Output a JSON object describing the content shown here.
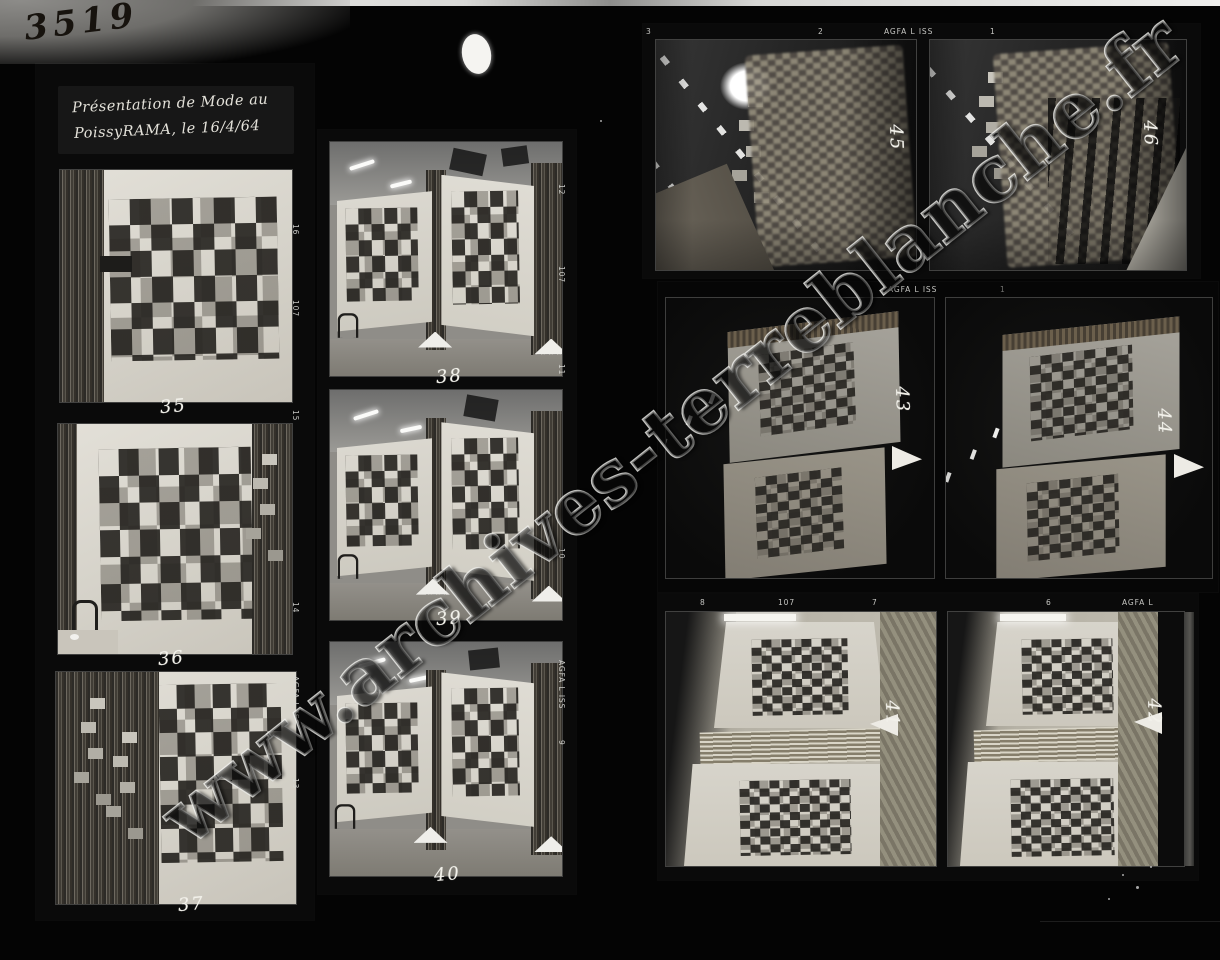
{
  "sheet": {
    "handwritten_number": "3519",
    "caption_line1": "Présentation de Mode au",
    "caption_line2": "PoissyRAMA, le 16/4/64",
    "watermark": "www.archives-terreblanche.fr"
  },
  "frame_numbers": {
    "f35": "35",
    "f36": "36",
    "f37": "37",
    "f38": "38",
    "f39": "39",
    "f40": "40",
    "f41": "41",
    "f42": "42",
    "f43": "43",
    "f44": "44",
    "f45": "45",
    "f46": "46"
  },
  "film_edge_markings": {
    "left_strip": [
      "16",
      "107",
      "15",
      "14",
      "AGFA L ISS",
      "13"
    ],
    "middle_strip": [
      "12",
      "107",
      "11",
      "10",
      "AGFA L ISS",
      "9"
    ],
    "top_right_strip": [
      "3",
      "2",
      "AGFA L ISS",
      "1"
    ],
    "middle_right_strip": [
      "AGFA L ISS",
      "1"
    ],
    "bottom_right_strip": [
      "8",
      "107",
      "7",
      "6",
      "AGFA L"
    ]
  },
  "colors": {
    "background": "#040404",
    "film_strip": "#0a0a0a",
    "print_paper": "#d6d3ca",
    "edge_text": "#d6d6d2",
    "handwriting_white": "#f2f1ea",
    "handwriting_dark": "#17130e"
  }
}
